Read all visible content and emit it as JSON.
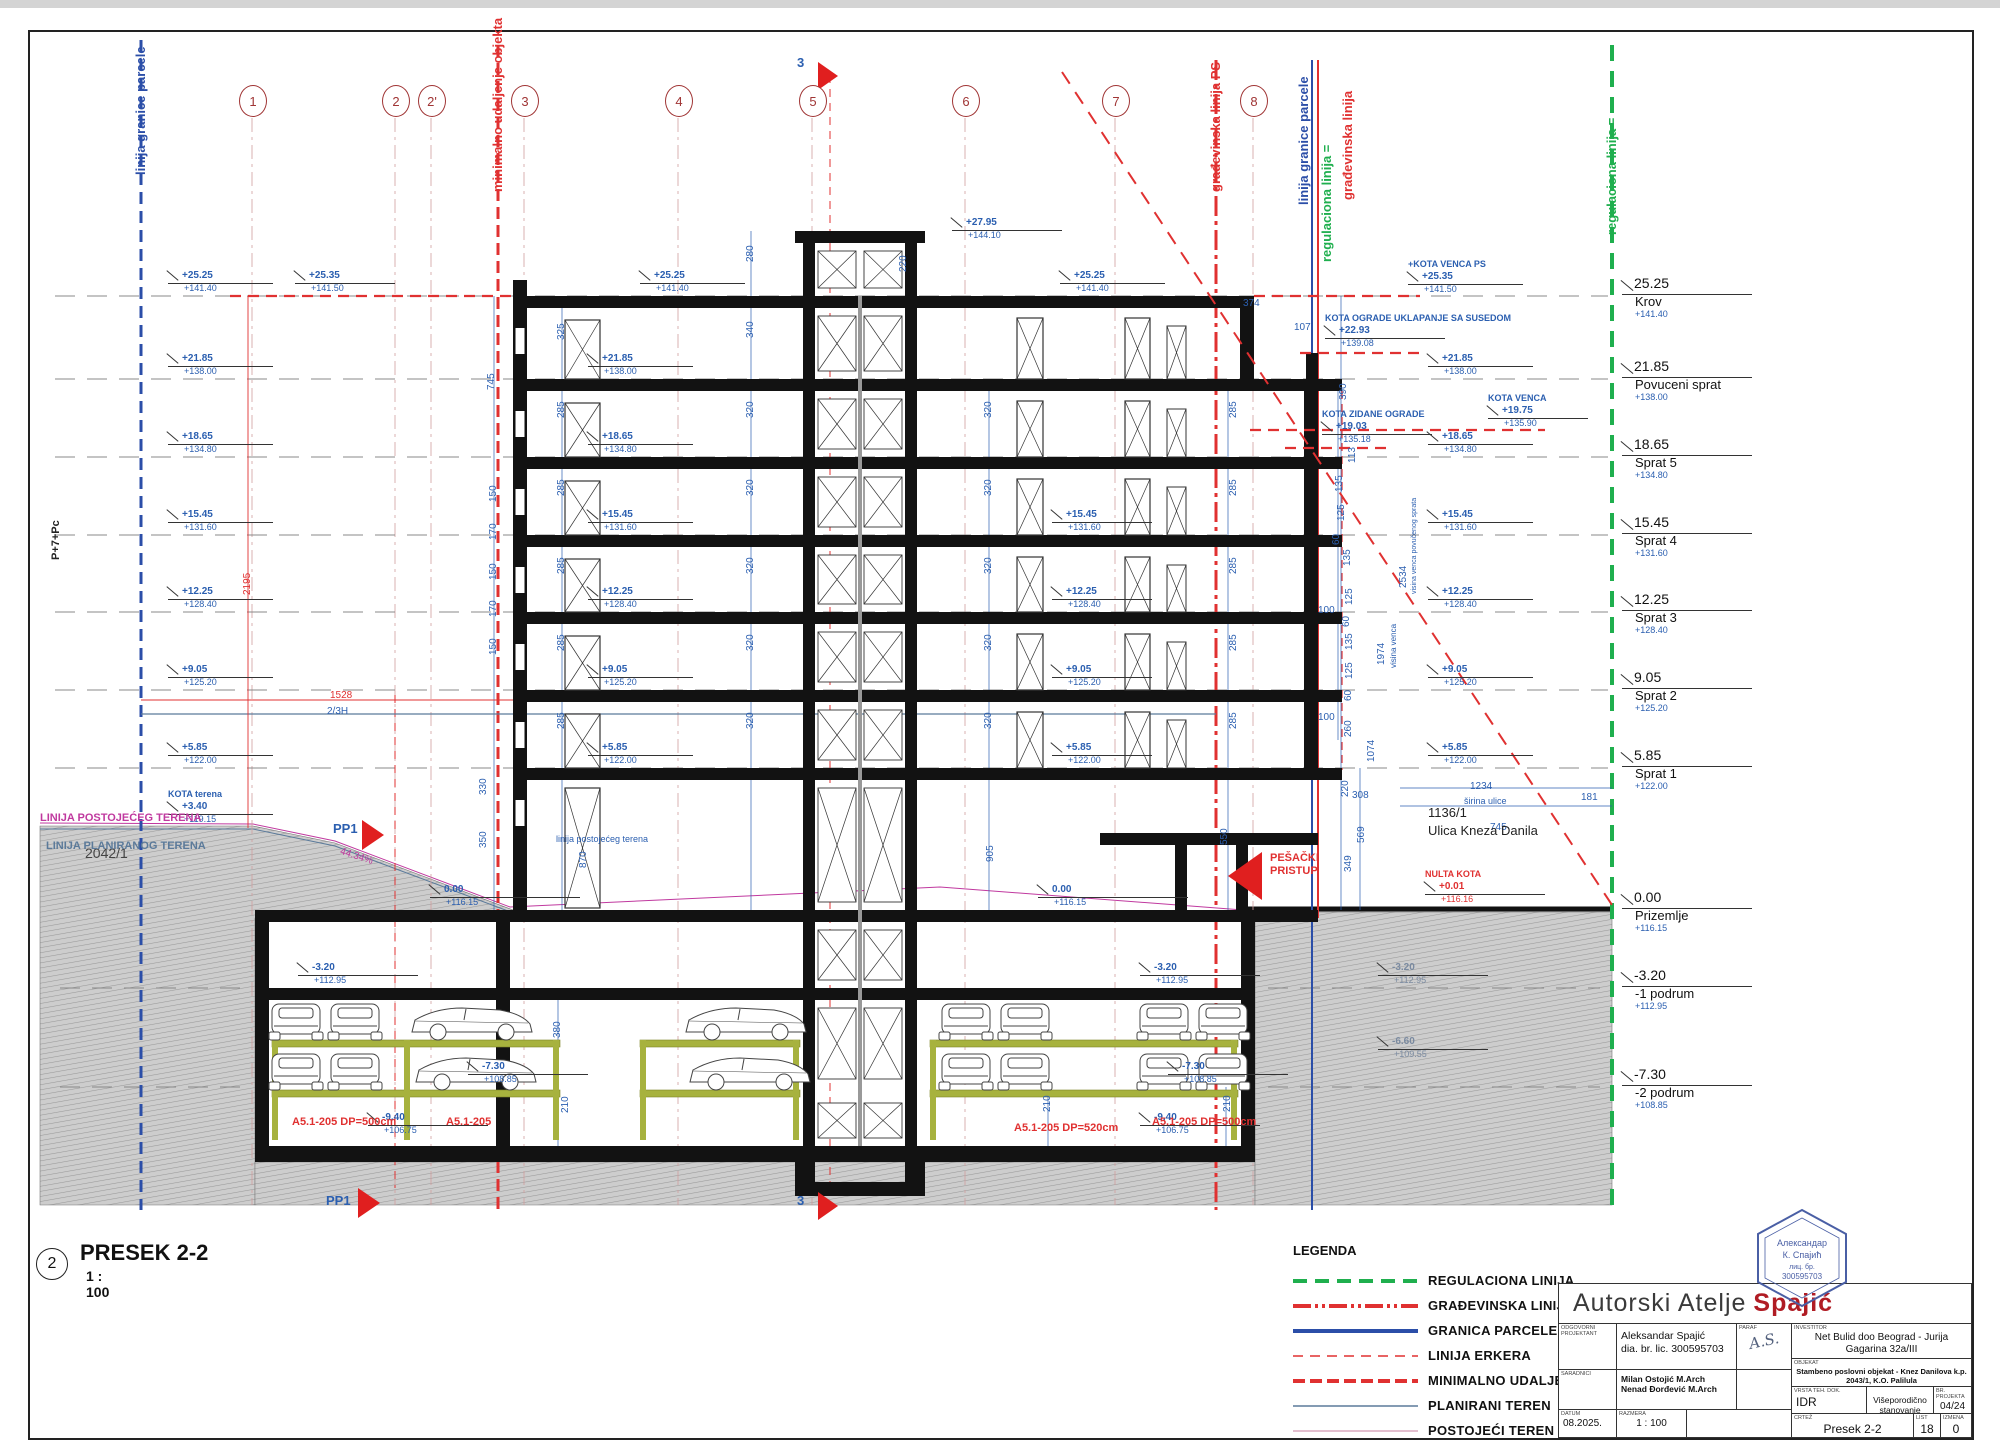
{
  "sheet_title": {
    "bubble": "2",
    "title": "PRESEK 2-2",
    "scale": "1 : 100"
  },
  "colors": {
    "anno_blue": "#2b5fb0",
    "line_blue": "#2b4ea8",
    "red": "#e03131",
    "green": "#1faf4e",
    "magenta": "#c0399f",
    "terrain_gray": "#7a8aa0",
    "slate": "#5b7a9a",
    "brand_red": "#b01c24"
  },
  "top_labels": [
    {
      "x": 133,
      "y": 175,
      "t": "linija granice parcele",
      "c": "#2b4ea8"
    },
    {
      "x": 490,
      "y": 192,
      "t": "minimalno udaljenje objekta",
      "c": "#e03131"
    },
    {
      "x": 1208,
      "y": 192,
      "t": "građevinska linija PS",
      "c": "#e03131"
    },
    {
      "x": 1296,
      "y": 205,
      "t": "linija granice parcele",
      "c": "#2b4ea8"
    },
    {
      "x": 1319,
      "y": 262,
      "t": "regulaciona linija =",
      "c": "#1faf4e"
    },
    {
      "x": 1340,
      "y": 200,
      "t": "građevinska linija",
      "c": "#e03131"
    },
    {
      "x": 1604,
      "y": 235,
      "t": "regulaciona linija =",
      "c": "#1faf4e"
    }
  ],
  "grid_bubbles": [
    {
      "label": "1",
      "x": 252
    },
    {
      "label": "2",
      "x": 395
    },
    {
      "label": "2'",
      "x": 431
    },
    {
      "label": "3",
      "x": 524
    },
    {
      "label": "4",
      "x": 678
    },
    {
      "label": "5",
      "x": 812
    },
    {
      "label": "6",
      "x": 965
    },
    {
      "label": "7",
      "x": 1115
    },
    {
      "label": "8",
      "x": 1253
    }
  ],
  "levels_right": [
    {
      "y": 296,
      "v": "25.25",
      "n": "Krov",
      "e": "+141.40"
    },
    {
      "y": 379,
      "v": "21.85",
      "n": "Povuceni sprat",
      "e": "+138.00"
    },
    {
      "y": 457,
      "v": "18.65",
      "n": "Sprat 5",
      "e": "+134.80"
    },
    {
      "y": 535,
      "v": "15.45",
      "n": "Sprat 4",
      "e": "+131.60"
    },
    {
      "y": 612,
      "v": "12.25",
      "n": "Sprat 3",
      "e": "+128.40"
    },
    {
      "y": 690,
      "v": "9.05",
      "n": "Sprat 2",
      "e": "+125.20"
    },
    {
      "y": 768,
      "v": "5.85",
      "n": "Sprat 1",
      "e": "+122.00"
    },
    {
      "y": 910,
      "v": "0.00",
      "n": "Prizemlje",
      "e": "+116.15"
    },
    {
      "y": 988,
      "v": "-3.20",
      "n": "-1 podrum",
      "e": "+112.95"
    },
    {
      "y": 1087,
      "v": "-7.30",
      "n": "-2 podrum",
      "e": "+108.85"
    }
  ],
  "flags": [
    {
      "x": 168,
      "y": 296,
      "w": 105,
      "v": "+25.25",
      "e": "+141.40"
    },
    {
      "x": 168,
      "y": 379,
      "w": 105,
      "v": "+21.85",
      "e": "+138.00"
    },
    {
      "x": 168,
      "y": 457,
      "w": 105,
      "v": "+18.65",
      "e": "+134.80"
    },
    {
      "x": 168,
      "y": 535,
      "w": 105,
      "v": "+15.45",
      "e": "+131.60"
    },
    {
      "x": 168,
      "y": 612,
      "w": 105,
      "v": "+12.25",
      "e": "+128.40"
    },
    {
      "x": 168,
      "y": 690,
      "w": 105,
      "v": "+9.05",
      "e": "+125.20"
    },
    {
      "x": 168,
      "y": 768,
      "w": 105,
      "v": "+5.85",
      "e": "+122.00"
    },
    {
      "x": 168,
      "y": 828,
      "w": 105,
      "v": "+3.40",
      "e": "+119.15",
      "t": "KOTA terena"
    },
    {
      "x": 295,
      "y": 296,
      "w": 100,
      "v": "+25.35",
      "e": "+141.50"
    },
    {
      "x": 640,
      "y": 296,
      "w": 105,
      "v": "+25.25",
      "e": "+141.40"
    },
    {
      "x": 1060,
      "y": 296,
      "w": 105,
      "v": "+25.25",
      "e": "+141.40"
    },
    {
      "x": 952,
      "y": 243,
      "w": 110,
      "v": "+27.95",
      "e": "+144.10"
    },
    {
      "x": 588,
      "y": 379,
      "w": 105,
      "v": "+21.85",
      "e": "+138.00"
    },
    {
      "x": 588,
      "y": 457,
      "w": 105,
      "v": "+18.65",
      "e": "+134.80"
    },
    {
      "x": 588,
      "y": 535,
      "w": 105,
      "v": "+15.45",
      "e": "+131.60"
    },
    {
      "x": 588,
      "y": 612,
      "w": 105,
      "v": "+12.25",
      "e": "+128.40"
    },
    {
      "x": 588,
      "y": 690,
      "w": 105,
      "v": "+9.05",
      "e": "+125.20"
    },
    {
      "x": 588,
      "y": 768,
      "w": 105,
      "v": "+5.85",
      "e": "+122.00"
    },
    {
      "x": 430,
      "y": 910,
      "w": 150,
      "v": "0.00",
      "e": "+116.15"
    },
    {
      "x": 1052,
      "y": 535,
      "w": 100,
      "v": "+15.45",
      "e": "+131.60"
    },
    {
      "x": 1052,
      "y": 612,
      "w": 100,
      "v": "+12.25",
      "e": "+128.40"
    },
    {
      "x": 1052,
      "y": 690,
      "w": 100,
      "v": "+9.05",
      "e": "+125.20"
    },
    {
      "x": 1052,
      "y": 768,
      "w": 100,
      "v": "+5.85",
      "e": "+122.00"
    },
    {
      "x": 1038,
      "y": 910,
      "w": 150,
      "v": "0.00",
      "e": "+116.15"
    },
    {
      "x": 1428,
      "y": 379,
      "w": 105,
      "v": "+21.85",
      "e": "+138.00"
    },
    {
      "x": 1428,
      "y": 457,
      "w": 105,
      "v": "+18.65",
      "e": "+134.80"
    },
    {
      "x": 1428,
      "y": 535,
      "w": 105,
      "v": "+15.45",
      "e": "+131.60"
    },
    {
      "x": 1428,
      "y": 612,
      "w": 105,
      "v": "+12.25",
      "e": "+128.40"
    },
    {
      "x": 1428,
      "y": 690,
      "w": 105,
      "v": "+9.05",
      "e": "+125.20"
    },
    {
      "x": 1428,
      "y": 768,
      "w": 105,
      "v": "+5.85",
      "e": "+122.00"
    },
    {
      "x": 1408,
      "y": 298,
      "w": 115,
      "v": "+25.35",
      "e": "+141.50",
      "t": "+KOTA VENCA PS"
    },
    {
      "x": 1325,
      "y": 352,
      "w": 120,
      "v": "+22.93",
      "e": "+139.08",
      "t": "KOTA OGRADE UKLAPANJE SA SUSEDOM"
    },
    {
      "x": 1488,
      "y": 432,
      "w": 100,
      "v": "+19.75",
      "e": "+135.90",
      "t": "KOTA VENCA"
    },
    {
      "x": 1322,
      "y": 448,
      "w": 110,
      "v": "+19.03",
      "e": "+135.18",
      "t": "KOTA ZIDANE OGRADE"
    },
    {
      "x": 1425,
      "y": 908,
      "w": 120,
      "v": "+0.01",
      "e": "+116.16",
      "t": "NULTA KOTA",
      "c": "red"
    },
    {
      "x": 298,
      "y": 988,
      "w": 120,
      "v": "-3.20",
      "e": "+112.95"
    },
    {
      "x": 1140,
      "y": 988,
      "w": 120,
      "v": "-3.20",
      "e": "+112.95"
    },
    {
      "x": 468,
      "y": 1087,
      "w": 120,
      "v": "-7.30",
      "e": "+108.85"
    },
    {
      "x": 1168,
      "y": 1087,
      "w": 120,
      "v": "-7.30",
      "e": "+108.85"
    },
    {
      "x": 368,
      "y": 1138,
      "w": 120,
      "v": "-9.40",
      "e": "+106.75"
    },
    {
      "x": 1140,
      "y": 1138,
      "w": 120,
      "v": "-9.40",
      "e": "+106.75"
    },
    {
      "x": 1378,
      "y": 988,
      "w": 110,
      "v": "-3.20",
      "e": "+112.95",
      "c": "gray"
    },
    {
      "x": 1378,
      "y": 1062,
      "w": 110,
      "v": "-6.60",
      "e": "+109.55",
      "c": "gray"
    }
  ],
  "dims": [
    {
      "x": 556,
      "y": 340,
      "t": "325",
      "r": 1
    },
    {
      "x": 556,
      "y": 418,
      "t": "285",
      "r": 1
    },
    {
      "x": 556,
      "y": 496,
      "t": "285",
      "r": 1
    },
    {
      "x": 556,
      "y": 574,
      "t": "285",
      "r": 1
    },
    {
      "x": 556,
      "y": 651,
      "t": "285",
      "r": 1
    },
    {
      "x": 556,
      "y": 729,
      "t": "285",
      "r": 1
    },
    {
      "x": 745,
      "y": 262,
      "t": "280",
      "r": 1
    },
    {
      "x": 745,
      "y": 338,
      "t": "340",
      "r": 1
    },
    {
      "x": 745,
      "y": 418,
      "t": "320",
      "r": 1
    },
    {
      "x": 745,
      "y": 496,
      "t": "320",
      "r": 1
    },
    {
      "x": 745,
      "y": 574,
      "t": "320",
      "r": 1
    },
    {
      "x": 745,
      "y": 651,
      "t": "320",
      "r": 1
    },
    {
      "x": 745,
      "y": 729,
      "t": "320",
      "r": 1
    },
    {
      "x": 898,
      "y": 272,
      "t": "220",
      "r": 1
    },
    {
      "x": 983,
      "y": 418,
      "t": "320",
      "r": 1
    },
    {
      "x": 983,
      "y": 496,
      "t": "320",
      "r": 1
    },
    {
      "x": 983,
      "y": 574,
      "t": "320",
      "r": 1
    },
    {
      "x": 983,
      "y": 651,
      "t": "320",
      "r": 1
    },
    {
      "x": 983,
      "y": 729,
      "t": "320",
      "r": 1
    },
    {
      "x": 1228,
      "y": 418,
      "t": "285",
      "r": 1
    },
    {
      "x": 1228,
      "y": 496,
      "t": "285",
      "r": 1
    },
    {
      "x": 1228,
      "y": 574,
      "t": "285",
      "r": 1
    },
    {
      "x": 1228,
      "y": 651,
      "t": "285",
      "r": 1
    },
    {
      "x": 1228,
      "y": 729,
      "t": "285",
      "r": 1
    },
    {
      "x": 985,
      "y": 862,
      "t": "905",
      "r": 1
    },
    {
      "x": 1219,
      "y": 845,
      "t": "550",
      "r": 1
    },
    {
      "x": 578,
      "y": 868,
      "t": "870",
      "r": 1
    },
    {
      "x": 486,
      "y": 390,
      "t": "745",
      "r": 1
    },
    {
      "x": 488,
      "y": 502,
      "t": "150",
      "r": 1
    },
    {
      "x": 488,
      "y": 540,
      "t": "170",
      "r": 1
    },
    {
      "x": 488,
      "y": 580,
      "t": "150",
      "r": 1
    },
    {
      "x": 488,
      "y": 617,
      "t": "170",
      "r": 1
    },
    {
      "x": 488,
      "y": 655,
      "t": "150",
      "r": 1
    },
    {
      "x": 478,
      "y": 795,
      "t": "330",
      "r": 1
    },
    {
      "x": 478,
      "y": 848,
      "t": "350",
      "r": 1
    },
    {
      "x": 1338,
      "y": 400,
      "t": "390",
      "r": 1
    },
    {
      "x": 1347,
      "y": 463,
      "t": "113",
      "r": 1
    },
    {
      "x": 1334,
      "y": 492,
      "t": "135",
      "r": 1
    },
    {
      "x": 1336,
      "y": 521,
      "t": "125",
      "r": 1
    },
    {
      "x": 1331,
      "y": 545,
      "t": "60",
      "r": 1
    },
    {
      "x": 1342,
      "y": 566,
      "t": "135",
      "r": 1
    },
    {
      "x": 1344,
      "y": 605,
      "t": "125",
      "r": 1
    },
    {
      "x": 1341,
      "y": 627,
      "t": "60",
      "r": 1
    },
    {
      "x": 1344,
      "y": 650,
      "t": "135",
      "r": 1
    },
    {
      "x": 1344,
      "y": 679,
      "t": "125",
      "r": 1
    },
    {
      "x": 1343,
      "y": 701,
      "t": "60",
      "r": 1
    },
    {
      "x": 1343,
      "y": 737,
      "t": "260",
      "r": 1
    },
    {
      "x": 1340,
      "y": 797,
      "t": "220",
      "r": 1
    },
    {
      "x": 1352,
      "y": 790,
      "t": "308",
      "r": 0
    },
    {
      "x": 1356,
      "y": 843,
      "t": "569",
      "r": 1
    },
    {
      "x": 1343,
      "y": 872,
      "t": "349",
      "r": 1
    },
    {
      "x": 1318,
      "y": 605,
      "t": "100",
      "r": 0
    },
    {
      "x": 1318,
      "y": 712,
      "t": "100",
      "r": 0
    },
    {
      "x": 1294,
      "y": 322,
      "t": "107",
      "r": 0
    },
    {
      "x": 1243,
      "y": 298,
      "t": "374",
      "r": 0
    },
    {
      "x": 1581,
      "y": 792,
      "t": "181",
      "r": 0
    },
    {
      "x": 1376,
      "y": 665,
      "t": "1974",
      "r": 1
    },
    {
      "x": 1389,
      "y": 668,
      "t": "visina venca",
      "r": 1,
      "s": 8
    },
    {
      "x": 1398,
      "y": 588,
      "t": "2534",
      "r": 1
    },
    {
      "x": 1411,
      "y": 594,
      "t": "visina venca povučenog sprata",
      "r": 1,
      "s": 7
    },
    {
      "x": 1366,
      "y": 762,
      "t": "1074",
      "r": 1
    },
    {
      "x": 1470,
      "y": 781,
      "t": "1234",
      "r": 0
    },
    {
      "x": 1464,
      "y": 796,
      "t": "širina ulice",
      "r": 0,
      "s": 9
    },
    {
      "x": 1490,
      "y": 822,
      "t": "745",
      "r": 0
    },
    {
      "x": 552,
      "y": 1038,
      "t": "380",
      "r": 1
    },
    {
      "x": 560,
      "y": 1113,
      "t": "210",
      "r": 1
    },
    {
      "x": 1042,
      "y": 1112,
      "t": "210",
      "r": 1
    },
    {
      "x": 1222,
      "y": 1112,
      "t": "210",
      "r": 1
    },
    {
      "x": 330,
      "y": 690,
      "t": "1528",
      "r": 0,
      "c": "#e03131"
    },
    {
      "x": 242,
      "y": 595,
      "t": "2195",
      "r": 1,
      "c": "#e03131"
    },
    {
      "x": 327,
      "y": 706,
      "t": "2/3H",
      "r": 0
    }
  ],
  "notes": [
    {
      "x": 50,
      "y": 560,
      "t": "P+7+Pc",
      "c": "#222",
      "s": 11,
      "b": 1,
      "r": -90
    },
    {
      "x": 85,
      "y": 845,
      "t": "2042/1",
      "c": "#444",
      "s": 14
    },
    {
      "x": 40,
      "y": 812,
      "t": "LINIJA POSTOJEĆEG TERENA",
      "c": "#c0399f",
      "s": 11,
      "b": 1
    },
    {
      "x": 46,
      "y": 840,
      "t": "LINIJA PLANIRANOG TERENA",
      "c": "#5b7a9a",
      "s": 11,
      "b": 1
    },
    {
      "x": 333,
      "y": 822,
      "t": "PP1",
      "c": "#2b5fb0",
      "s": 13,
      "b": 1
    },
    {
      "x": 342,
      "y": 846,
      "t": "44.34%",
      "c": "#c0399f",
      "s": 10,
      "r": 18
    },
    {
      "x": 326,
      "y": 1194,
      "t": "PP1",
      "c": "#2b5fb0",
      "s": 13,
      "b": 1
    },
    {
      "x": 797,
      "y": 56,
      "t": "3",
      "c": "#2b5fb0",
      "s": 13,
      "b": 1
    },
    {
      "x": 797,
      "y": 1194,
      "t": "3",
      "c": "#2b5fb0",
      "s": 13,
      "b": 1
    },
    {
      "x": 1270,
      "y": 852,
      "t": "PEŠAČKI\nPRISTUP",
      "c": "#e03131",
      "s": 11,
      "b": 1
    },
    {
      "x": 556,
      "y": 834,
      "t": "linija postojećeg terena",
      "c": "#2b5fb0",
      "s": 9
    },
    {
      "x": 1428,
      "y": 806,
      "t": "1136/1",
      "c": "#222",
      "s": 13
    },
    {
      "x": 1428,
      "y": 824,
      "t": "Ulica Kneza Danila",
      "c": "#222",
      "s": 13
    },
    {
      "x": 292,
      "y": 1116,
      "t": "A5.1-205 DP=500cm",
      "c": "#e03131",
      "s": 11,
      "b": 1
    },
    {
      "x": 446,
      "y": 1116,
      "t": "A5.1-205",
      "c": "#e03131",
      "s": 11,
      "b": 1
    },
    {
      "x": 1014,
      "y": 1122,
      "t": "A5.1-205 DP=520cm",
      "c": "#e03131",
      "s": 11,
      "b": 1
    },
    {
      "x": 1152,
      "y": 1116,
      "t": "A5.1-205 DP=500cm",
      "c": "#e03131",
      "s": 11,
      "b": 1
    }
  ],
  "legend": {
    "title": "LEGENDA",
    "items": [
      {
        "label": "REGULACIONA LINIJA",
        "style": "regulaciona"
      },
      {
        "label": "GRAĐEVINSKA LINIJA",
        "style": "gradjevinska"
      },
      {
        "label": "GRANICA PARCELE",
        "style": "granica"
      },
      {
        "label": "LINIJA ERKERA",
        "style": "erker"
      },
      {
        "label": "MINIMALNO UDALJENJE",
        "style": "minimalno"
      },
      {
        "label": "PLANIRANI TEREN",
        "style": "planirani"
      },
      {
        "label": "POSTOJEĆI TEREN",
        "style": "postojeci"
      }
    ]
  },
  "tb": {
    "studio_black": "Autorski Atelje",
    "studio_red": "Spajić",
    "lbl_odg": "ODGOVORNI\nPROJEKTANT",
    "lbl_paraf": "PARAF",
    "lbl_inv": "INVESTITOR",
    "lbl_sar": "SARADNICI",
    "lbl_obj": "OBJEKAT",
    "lbl_vrsta": "VRSTA TEH. DOK.",
    "lbl_brpr": "BR. PROJEKTA",
    "lbl_datum": "DATUM",
    "lbl_razmera": "RAZMERA",
    "lbl_crtez": "CRTEŽ",
    "lbl_list": "LIST",
    "lbl_izmena": "IZMENA",
    "odg": "Aleksandar Spajić\ndia. br. lic. 300595703",
    "paraf": "A.S.",
    "saradnici": "Milan Ostojić M.Arch\nNenad Đorđević M.Arch",
    "investitor": "Net Bulid doo Beograd - Jurija Gagarina 32a/III",
    "objekat": "Stambeno poslovni objekat - Knez Danilova k.p. 2043/1, K.O. Palilula",
    "vrsta": "IDR",
    "namena": "Višeporodično stanovanje",
    "br_projekta": "04/24",
    "datum": "08.2025.",
    "razmera": "1 : 100",
    "crtez": "Presek 2-2",
    "list": "18",
    "izmena": "0"
  },
  "stamp": {
    "l1": "Александар",
    "l2": "К. Спајић",
    "l3": "лиц. бр.",
    "l4": "300595703"
  }
}
